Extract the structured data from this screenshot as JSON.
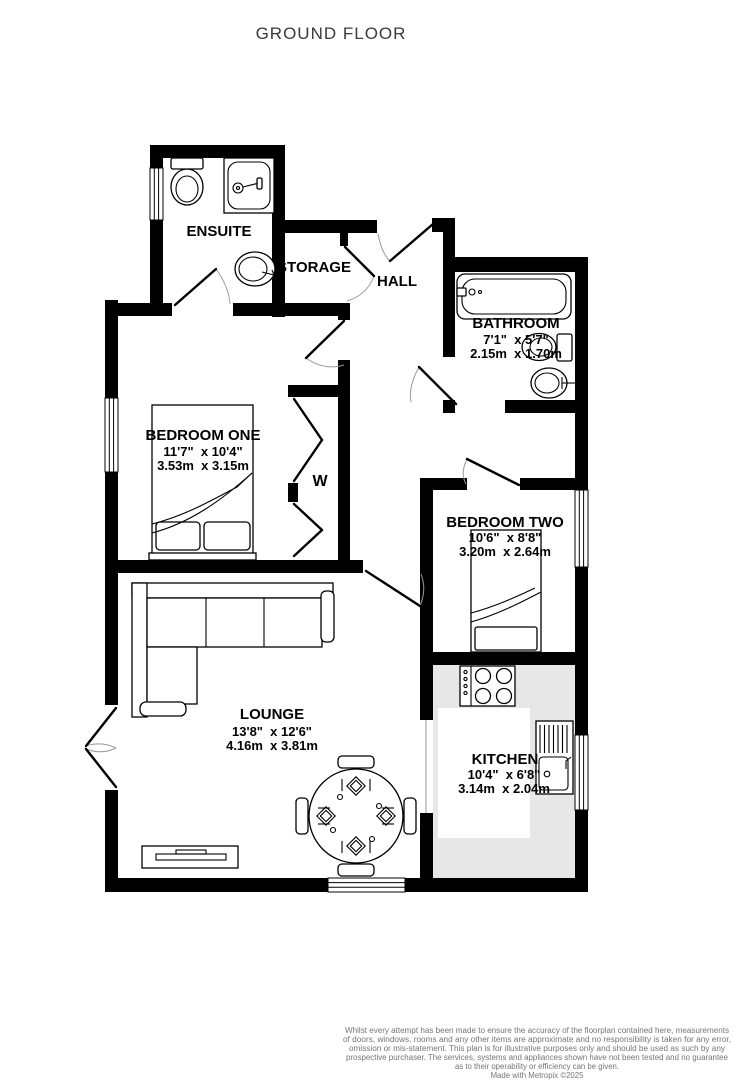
{
  "title": "GROUND FLOOR",
  "rooms": [
    {
      "name": "ENSUITE"
    },
    {
      "name": "STORAGE"
    },
    {
      "name": "HALL"
    },
    {
      "name": "BATHROOM",
      "imperial": "7'1\"  x 5'7\"",
      "metric": "2.15m  x 1.70m"
    },
    {
      "name": "BEDROOM ONE",
      "imperial": "11'7\"  x 10'4\"",
      "metric": "3.53m  x 3.15m"
    },
    {
      "name": "W"
    },
    {
      "name": "BEDROOM TWO",
      "imperial": "10'6\"  x 8'8\"",
      "metric": "3.20m  x 2.64m"
    },
    {
      "name": "LOUNGE",
      "imperial": "13'8\"  x 12'6\"",
      "metric": "4.16m  x 3.81m"
    },
    {
      "name": "KITCHEN",
      "imperial": "10'4\"  x 6'8\"",
      "metric": "3.14m  x 2.04m"
    }
  ],
  "disclaimer": {
    "lines": [
      "Whilst every attempt has been made to ensure the accuracy of the floorplan contained here, measurements",
      "of doors, windows, rooms and any other items are approximate and no responsibility is taken for any error,",
      "omission or mis-statement. This plan is for illustrative purposes only and should be used as such by any",
      "prospective purchaser. The services, systems and appliances shown have not been tested and no guarantee",
      "as to their operability or efficiency can be given."
    ],
    "credit": "Made with Metropix ©2025"
  },
  "colors": {
    "wall": "#000000",
    "kitchen_counter": "#e7e7e7",
    "door_arc": "#9a9a9a",
    "title_text": "#3a3a3a",
    "footer_text": "#757575"
  }
}
